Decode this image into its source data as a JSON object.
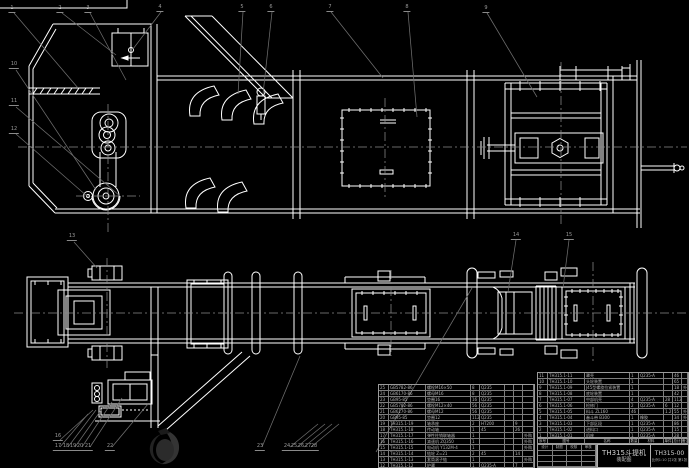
{
  "drawing": {
    "product": "TH315斗提机",
    "doc_type": "装配图",
    "drawing_no": "TH315-00",
    "footer_note": "比例1:10 共1张 第1张",
    "colors": {
      "background": "#000000",
      "line": "#ffffff",
      "leader": "#6f6f6f",
      "table_line": "#9a9a9a",
      "text": "#b5b5b5"
    }
  },
  "bom": {
    "header": {
      "no": "序号",
      "code": "图号",
      "name": "名称",
      "qty": "数量",
      "mat": "材料",
      "w1": "单件",
      "w2": "总计",
      "rem": "备注"
    },
    "left_rows": [
      {
        "no": "25",
        "code": "GB5782-86",
        "name": "螺栓M16×50",
        "qty": "8",
        "mat": "Q235",
        "w1": "",
        "w2": "",
        "rem": ""
      },
      {
        "no": "24",
        "code": "GB6170-86",
        "name": "螺母M16",
        "qty": "8",
        "mat": "Q235",
        "w1": "",
        "w2": "",
        "rem": ""
      },
      {
        "no": "23",
        "code": "GB95-85",
        "name": "垫圈16",
        "qty": "16",
        "mat": "Q235",
        "w1": "",
        "w2": "",
        "rem": ""
      },
      {
        "no": "22",
        "code": "GB5782-86",
        "name": "螺栓M12×40",
        "qty": "56",
        "mat": "Q235",
        "w1": "",
        "w2": "",
        "rem": ""
      },
      {
        "no": "21",
        "code": "GB6170-86",
        "name": "螺母M12",
        "qty": "56",
        "mat": "Q235",
        "w1": "",
        "w2": "",
        "rem": ""
      },
      {
        "no": "20",
        "code": "GB95-85",
        "name": "垫圈12",
        "qty": "112",
        "mat": "Q235",
        "w1": "",
        "w2": "",
        "rem": ""
      },
      {
        "no": "19",
        "code": "TH315.1-19",
        "name": "轴承座",
        "qty": "2",
        "mat": "HT200",
        "w1": "",
        "w2": "9",
        "rem": ""
      },
      {
        "no": "18",
        "code": "TH315.1-18",
        "name": "传动轴",
        "qty": "1",
        "mat": "45",
        "w1": "",
        "w2": "26",
        "rem": ""
      },
      {
        "no": "17",
        "code": "TH315.1-17",
        "name": "弹性柱销联轴器",
        "qty": "1",
        "mat": "",
        "w1": "",
        "w2": "",
        "rem": "外购"
      },
      {
        "no": "16",
        "code": "TH315.1-16",
        "name": "减速机 ZQ350",
        "qty": "1",
        "mat": "",
        "w1": "",
        "w2": "",
        "rem": "外购"
      },
      {
        "no": "15",
        "code": "TH315.1-15",
        "name": "电动机 Y132M-4",
        "qty": "1",
        "mat": "",
        "w1": "",
        "w2": "",
        "rem": "外购"
      },
      {
        "no": "14",
        "code": "TH315.1-14",
        "name": "链轮 Z=21",
        "qty": "2",
        "mat": "45",
        "w1": "",
        "w2": "14",
        "rem": ""
      },
      {
        "no": "13",
        "code": "TH315.1-13",
        "name": "套筒滚子链",
        "qty": "1",
        "mat": "",
        "w1": "",
        "w2": "",
        "rem": "外购"
      },
      {
        "no": "12",
        "code": "TH315.1-12",
        "name": "护罩",
        "qty": "1",
        "mat": "Q235-A",
        "w1": "",
        "w2": "7",
        "rem": ""
      }
    ],
    "right_rows": [
      {
        "no": "11",
        "code": "TH315.1-11",
        "name": "罩壳",
        "qty": "1",
        "mat": "Q235-A",
        "w1": "",
        "w2": "46",
        "rem": ""
      },
      {
        "no": "10",
        "code": "TH315.1-10",
        "name": "头轮装置",
        "qty": "1",
        "mat": "",
        "w1": "",
        "w2": "65",
        "rem": ""
      },
      {
        "no": "9",
        "code": "TH315.1-09",
        "name": "J45型螺旋拉紧装置",
        "qty": "1",
        "mat": "",
        "w1": "",
        "w2": "18",
        "rem": "外购"
      },
      {
        "no": "8",
        "code": "TH315.1-08",
        "name": "底轮装置",
        "qty": "1",
        "mat": "",
        "w1": "",
        "w2": "42",
        "rem": ""
      },
      {
        "no": "7",
        "code": "TH315.1-07",
        "name": "中部机壳",
        "qty": "4",
        "mat": "Q235-A",
        "w1": "28",
        "w2": "112",
        "rem": ""
      },
      {
        "no": "6",
        "code": "TH315.1-06",
        "name": "检修门",
        "qty": "2",
        "mat": "Q235-A",
        "w1": "6",
        "w2": "12",
        "rem": ""
      },
      {
        "no": "5",
        "code": "TH315.1-05",
        "name": "料斗 ZL160",
        "qty": "46",
        "mat": "",
        "w1": "1.2",
        "w2": "55",
        "rem": "外购"
      },
      {
        "no": "4",
        "code": "TH315.1-04",
        "name": "畚斗带 B300",
        "qty": "1",
        "mat": "橡胶",
        "w1": "",
        "w2": "34",
        "rem": "外购"
      },
      {
        "no": "3",
        "code": "TH315.1-03",
        "name": "下部区段",
        "qty": "1",
        "mat": "Q235-A",
        "w1": "",
        "w2": "86",
        "rem": ""
      },
      {
        "no": "2",
        "code": "TH315.1-02",
        "name": "进料口",
        "qty": "1",
        "mat": "Q235-A",
        "w1": "",
        "w2": "15",
        "rem": ""
      },
      {
        "no": "1",
        "code": "TH315.1-01",
        "name": "机座",
        "qty": "1",
        "mat": "Q235-A",
        "w1": "",
        "w2": "28",
        "rem": ""
      }
    ]
  },
  "signature": {
    "labels": [
      "设计",
      "制图",
      "校核",
      "审核"
    ]
  },
  "callouts": [
    {
      "label": "1",
      "x": 12,
      "y": 6
    },
    {
      "label": "2",
      "x": 60,
      "y": 6
    },
    {
      "label": "3",
      "x": 88,
      "y": 6
    },
    {
      "label": "4",
      "x": 160,
      "y": 5
    },
    {
      "label": "5",
      "x": 242,
      "y": 5
    },
    {
      "label": "6",
      "x": 271,
      "y": 5
    },
    {
      "label": "7",
      "x": 330,
      "y": 5
    },
    {
      "label": "8",
      "x": 407,
      "y": 5
    },
    {
      "label": "9",
      "x": 486,
      "y": 6
    },
    {
      "label": "10",
      "x": 14,
      "y": 62
    },
    {
      "label": "11",
      "x": 14,
      "y": 99
    },
    {
      "label": "12",
      "x": 14,
      "y": 127
    },
    {
      "label": "13",
      "x": 72,
      "y": 234
    },
    {
      "label": "14",
      "x": 516,
      "y": 233
    },
    {
      "label": "15",
      "x": 569,
      "y": 233
    },
    {
      "label": "16",
      "x": 58,
      "y": 434
    },
    {
      "label": "17",
      "x": 58,
      "y": 444
    },
    {
      "label": "18",
      "x": 66,
      "y": 444
    },
    {
      "label": "19",
      "x": 73,
      "y": 444
    },
    {
      "label": "20",
      "x": 80,
      "y": 444
    },
    {
      "label": "21",
      "x": 88,
      "y": 444
    },
    {
      "label": "22",
      "x": 110,
      "y": 444
    },
    {
      "label": "23",
      "x": 260,
      "y": 444
    },
    {
      "label": "24",
      "x": 287,
      "y": 444
    },
    {
      "label": "25",
      "x": 294,
      "y": 444
    },
    {
      "label": "26",
      "x": 301,
      "y": 444
    },
    {
      "label": "27",
      "x": 308,
      "y": 444
    },
    {
      "label": "28",
      "x": 314,
      "y": 444
    }
  ]
}
